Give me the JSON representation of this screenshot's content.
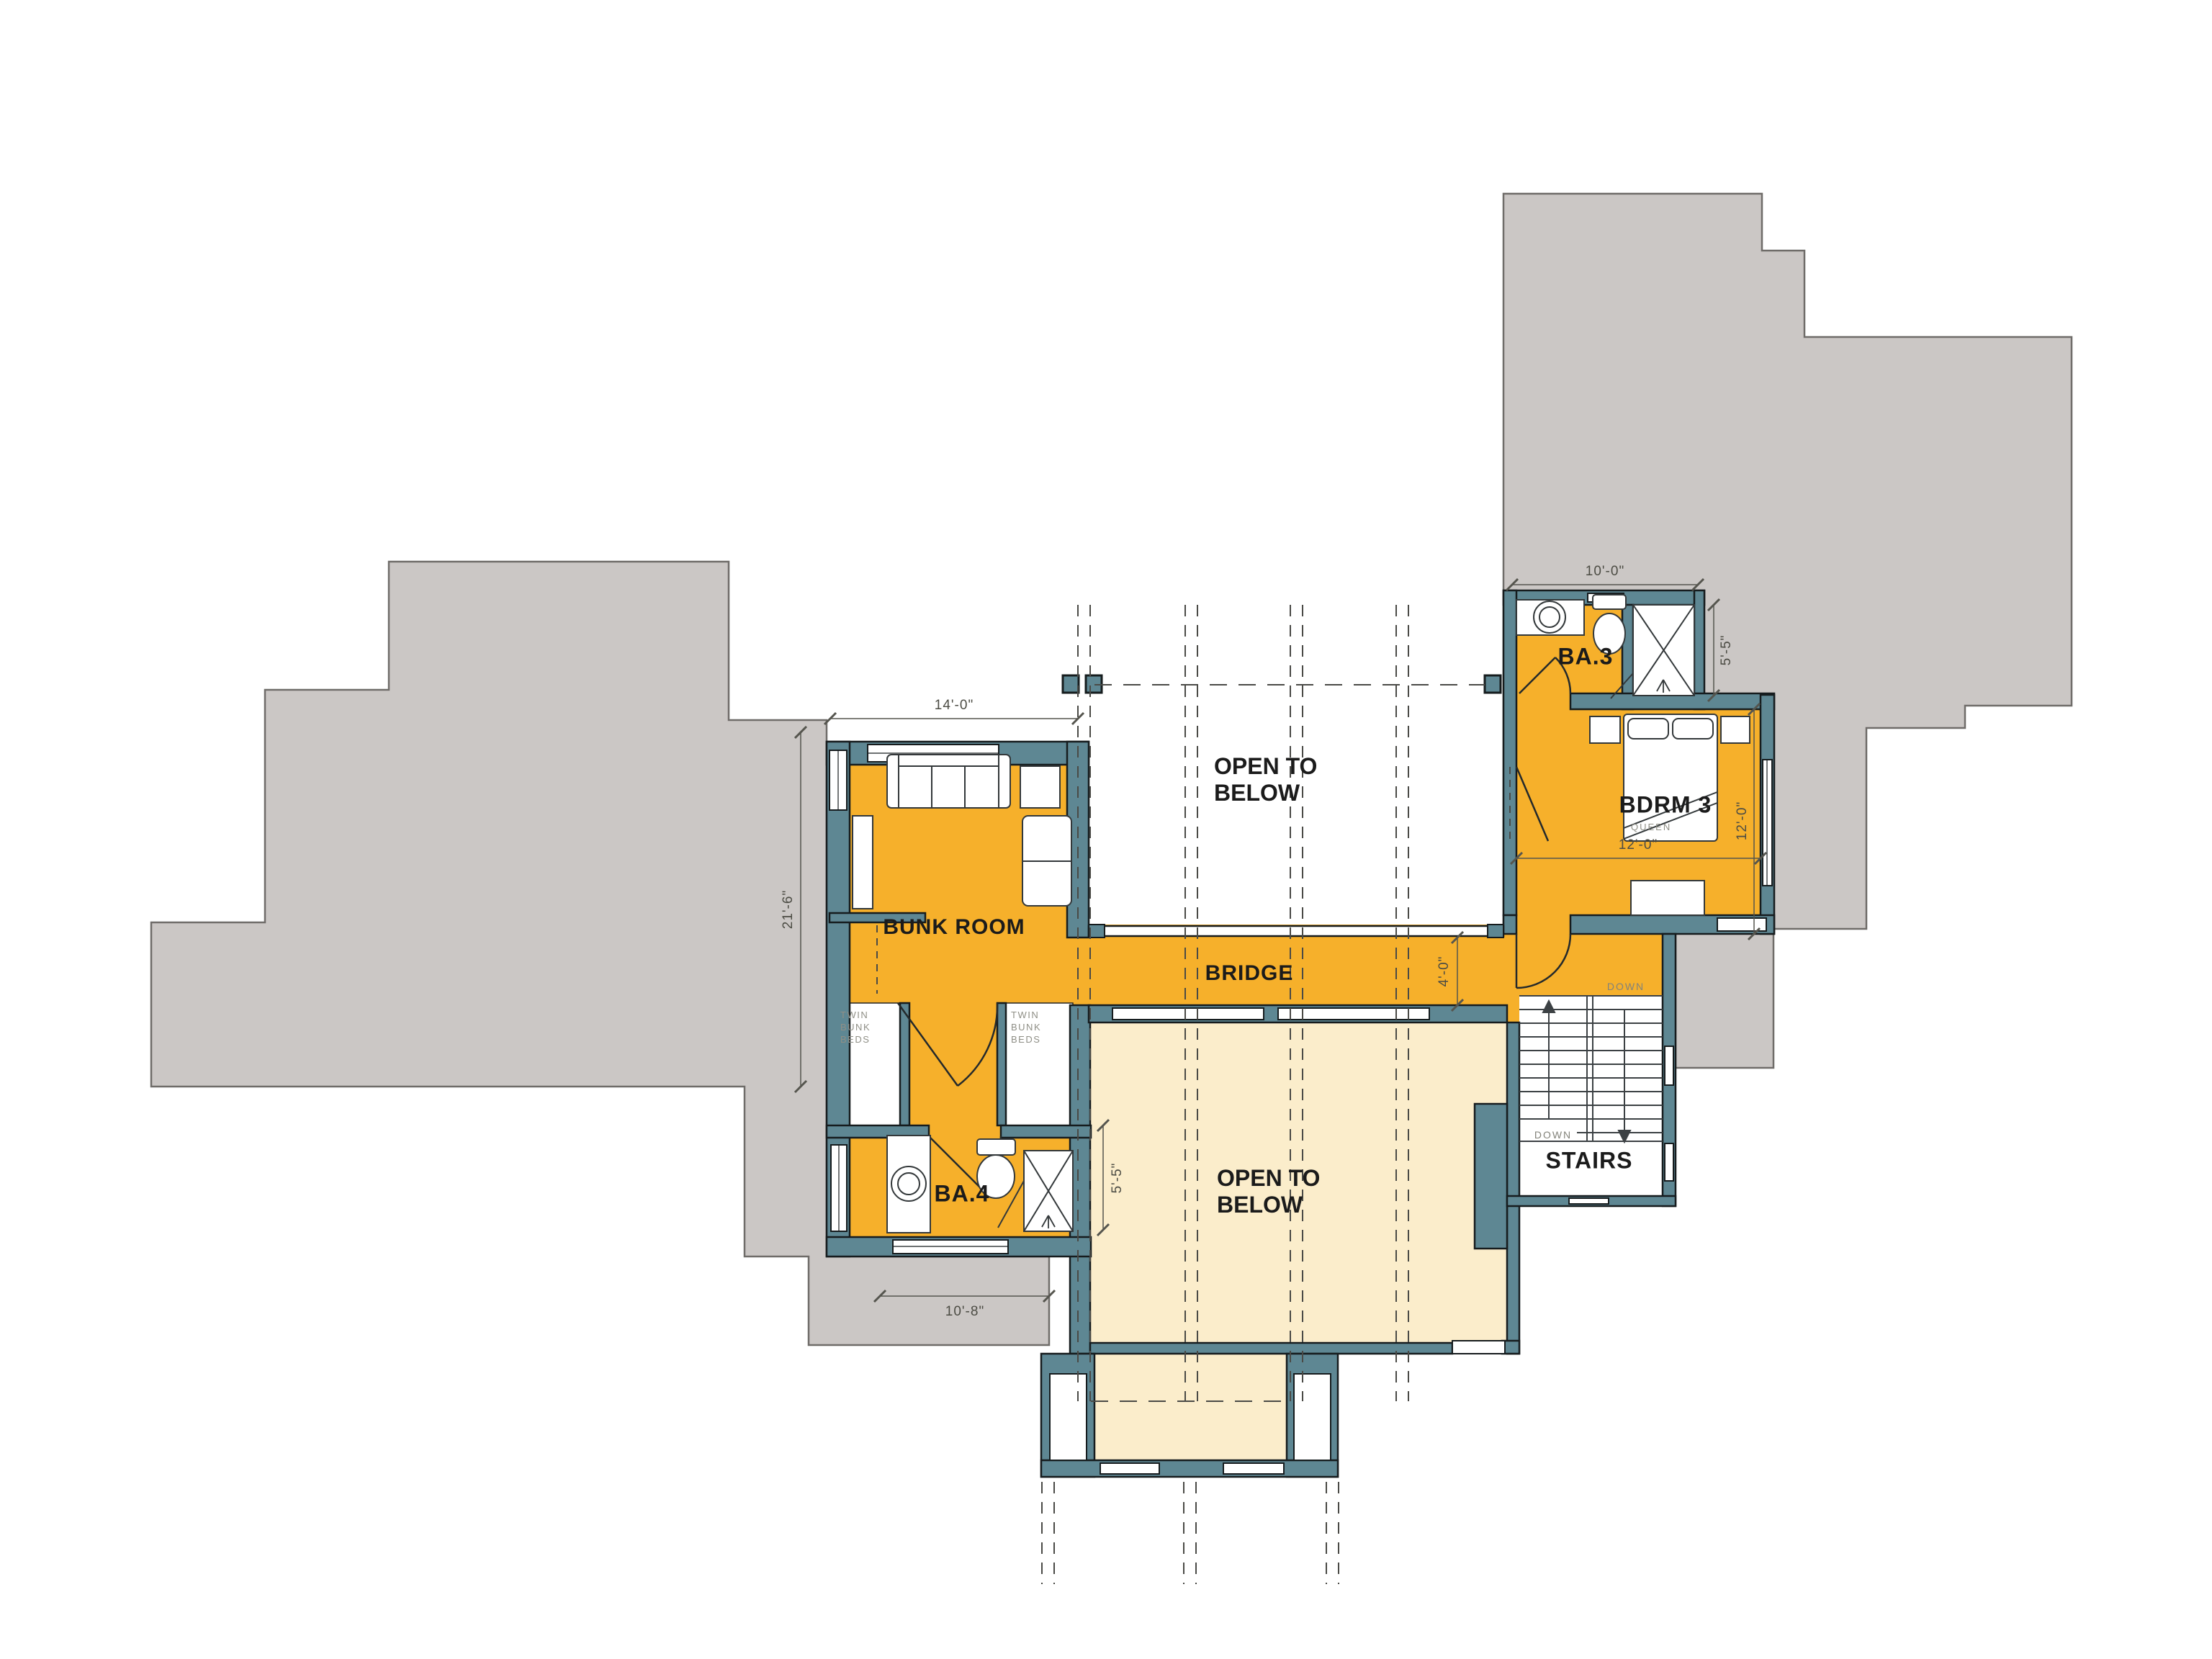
{
  "colors": {
    "room_fill": "#F6B02B",
    "open_below_fill": "#FBEDCB",
    "roof_fill": "#CBC7C5",
    "wall_fill": "#5E8793",
    "wall_outline": "#161C1E",
    "dimension_color": "#4C4C44",
    "label_color": "#1B1B1B"
  },
  "rooms": {
    "bunk_room": {
      "label": "BUNK ROOM"
    },
    "ba4": {
      "label": "BA.4"
    },
    "ba3": {
      "label": "BA.3"
    },
    "bdrm3": {
      "label": "BDRM 3",
      "bed_type": "QUEEN"
    },
    "bridge": {
      "label": "BRIDGE"
    },
    "stairs": {
      "label": "STAIRS",
      "down_upper": "DOWN",
      "down_lower": "DOWN"
    },
    "open_to_below_upper": {
      "label": "OPEN TO BELOW"
    },
    "open_to_below_lower": {
      "label": "OPEN TO BELOW"
    },
    "twin_bunk_left": {
      "label": "TWIN BUNK BEDS"
    },
    "twin_bunk_right": {
      "label": "TWIN BUNK BEDS"
    }
  },
  "dimensions": {
    "bunk_room_width": "14'-0\"",
    "bunk_room_depth": "21'-6\"",
    "ba4_width": "10'-8\"",
    "ba4_depth": "5'-5\"",
    "ba3_width": "10'-0\"",
    "ba3_depth": "5'-5\"",
    "bdrm3_width": "12'-0\"",
    "bdrm3_depth": "12'-0\"",
    "bridge_width": "4'-0\""
  }
}
